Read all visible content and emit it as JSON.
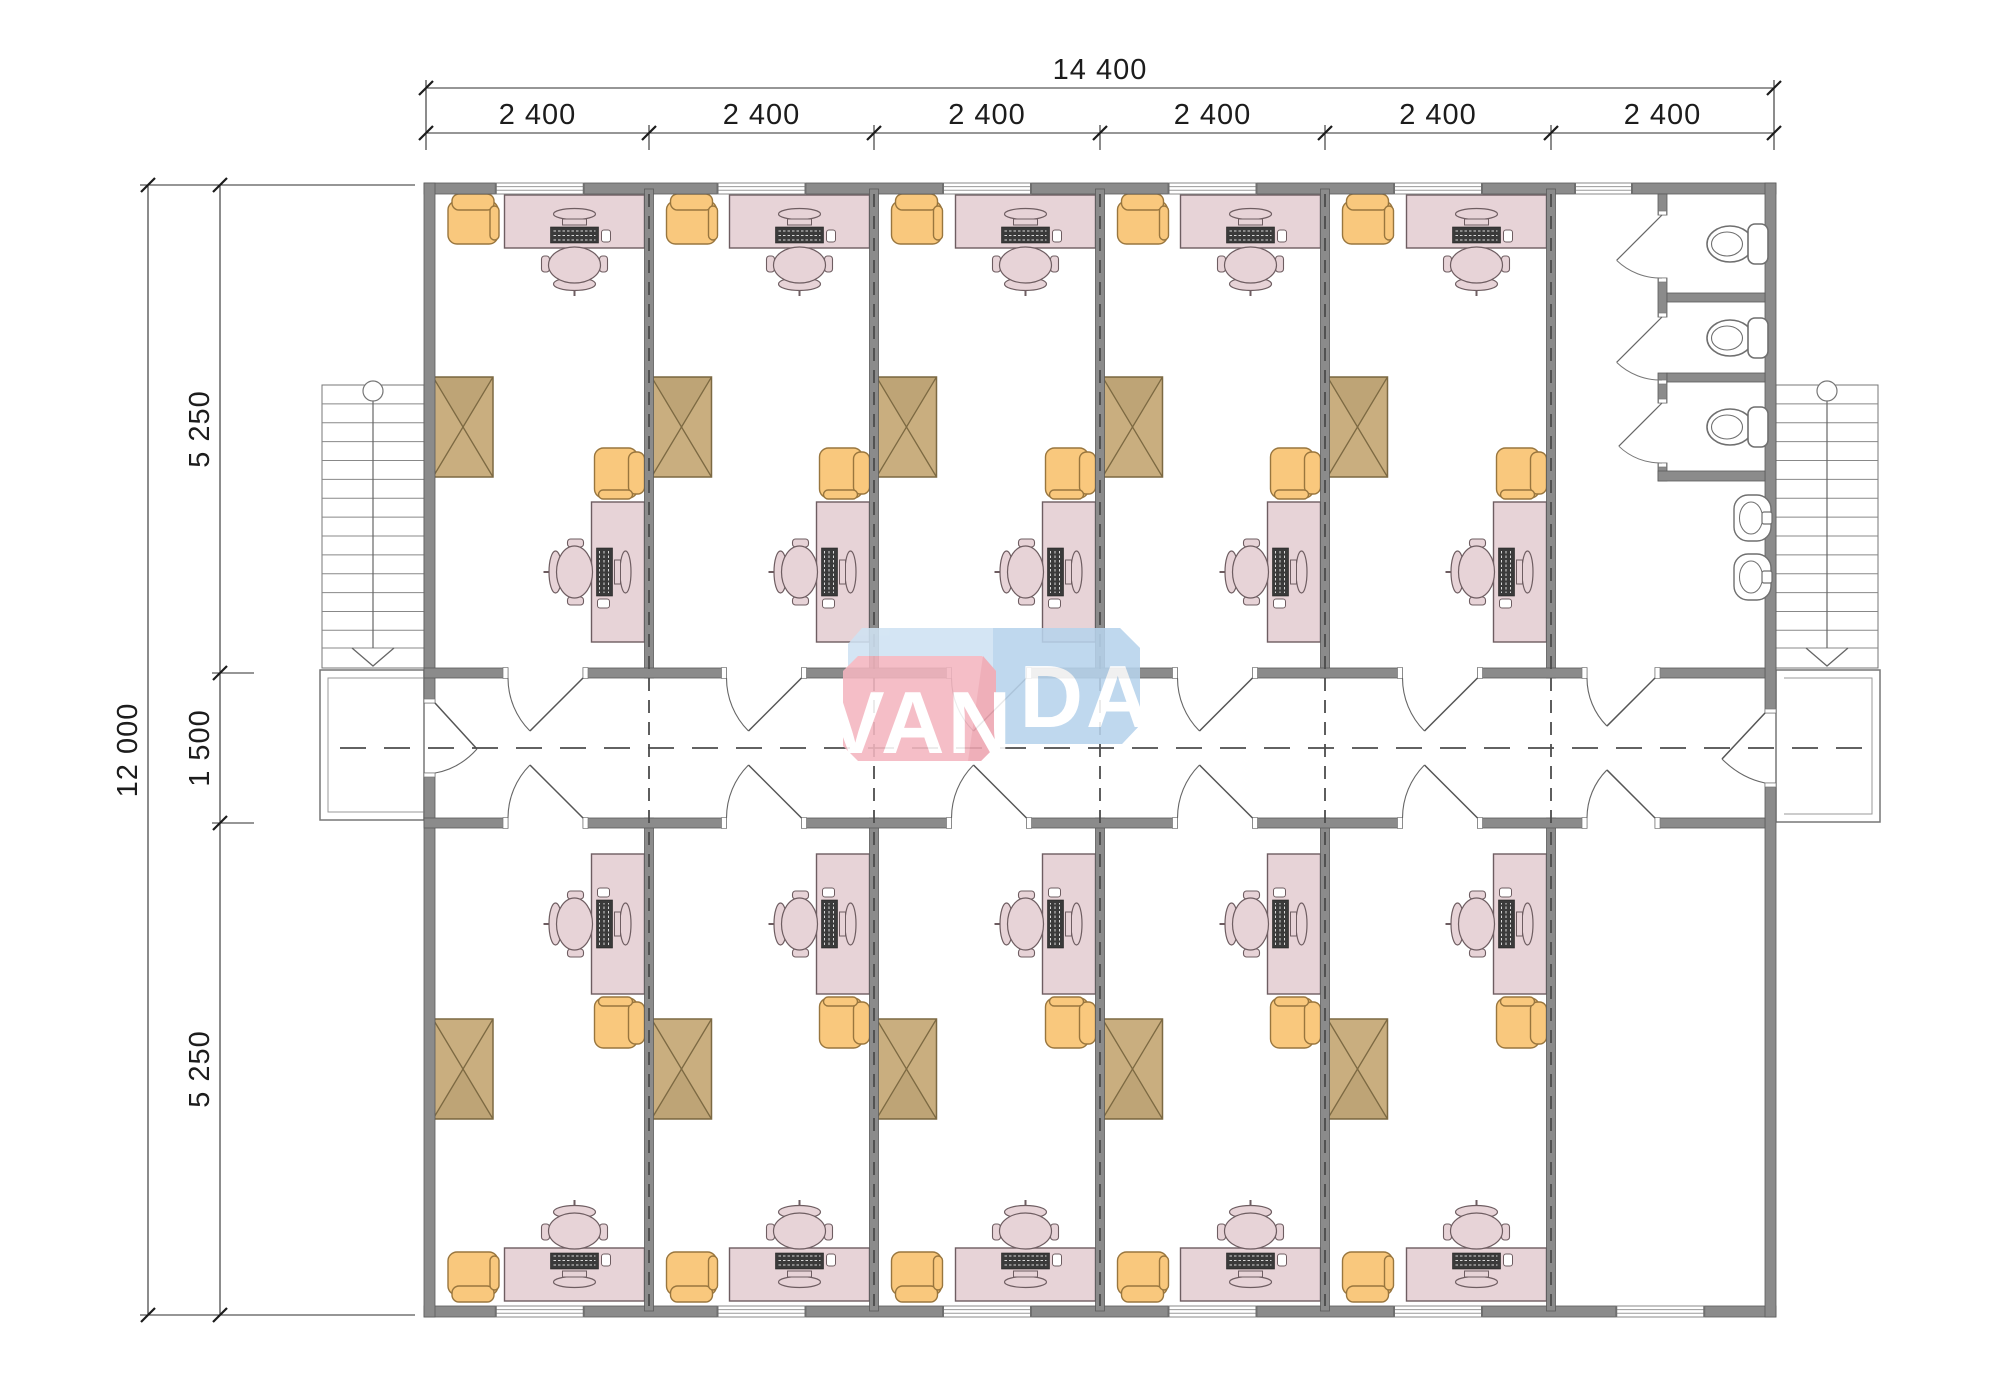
{
  "drawing": {
    "type": "architectural-floor-plan",
    "logo": {
      "text_left": "VAN",
      "text_right": "DA",
      "full_text": "VANDA"
    },
    "dimensions": {
      "top_total": "14 400",
      "top_segments": [
        "2 400",
        "2 400",
        "2 400",
        "2 400",
        "2 400",
        "2 400"
      ],
      "left_total": "12 000",
      "left_segments": [
        "5 250",
        "1 500",
        "5 250"
      ]
    },
    "structure": {
      "office_rooms": 10,
      "bays": 6,
      "toilet_stalls": 3,
      "toilets": 3,
      "sinks": 2,
      "staircases": 2,
      "entrance_landings": 2,
      "corridor": 1
    },
    "colors": {
      "wall": "#8b8b8b",
      "wall_edge": "#5a5a5a",
      "desk": "#e7d3d7",
      "desk_edge": "#6e5d61",
      "armchair": "#f9c87d",
      "armchair_edge": "#99763e",
      "cabinet": "#c9ae7f",
      "cabinet_edge": "#7c6942",
      "fixture": "#ffffff",
      "fixture_edge": "#6f6f6f",
      "dash": "#4c4c4c",
      "dim": "#2e2e2e",
      "logo_pink": "#f4b6c0",
      "logo_pink_dark": "#eda4b0",
      "logo_blue": "#cfe2f3",
      "logo_blue_dark": "#b7d3ec",
      "logo_text": "#ffffff"
    }
  }
}
